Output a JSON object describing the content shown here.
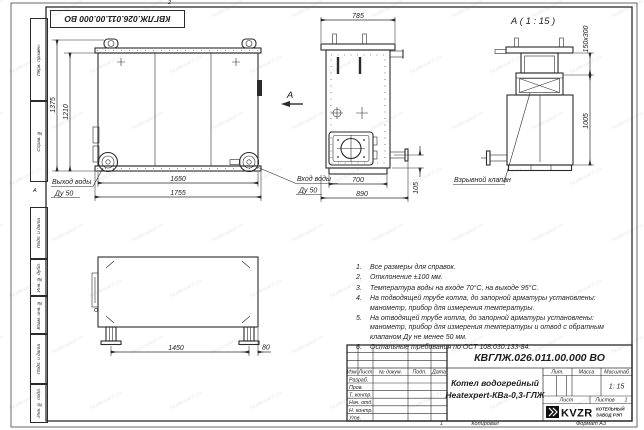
{
  "sheet": {
    "stamp_mirrored": "КВГЛЖ.026.011.00.000 ВО",
    "watermark": "heatexpert.ru",
    "zones": {
      "top": "2",
      "bottom": "1",
      "left": "А"
    },
    "margin_labels": {
      "top": [
        "Перв. примен.",
        "Справ. №"
      ],
      "bottom": [
        "Подп. и дата",
        "Инв. № дубл.",
        "Взам. инв. №",
        "Подп. и дата",
        "Инв. № подл."
      ]
    },
    "footer": {
      "copied": "Копировал",
      "format": "Формат А3"
    }
  },
  "views": {
    "front": {
      "dims": {
        "inner_width": "1650",
        "outer_width": "1755",
        "outer_height": "1375",
        "inner_height": "1210"
      },
      "outlet_label": "Выход воды",
      "outlet_dn": "Ду 50",
      "inlet_label": "Вход воды",
      "inlet_dn": "Ду 50",
      "section_arrow": "А"
    },
    "side": {
      "dims": {
        "depth": "785",
        "base_inner": "700",
        "base_outer": "890",
        "nozzle_height": "105"
      }
    },
    "detail": {
      "title": "А ( 1 : 15 )",
      "valve_label": "Взрывной клапан",
      "dims": {
        "valve_size": "150х300",
        "height": "1005"
      }
    },
    "bottom": {
      "dims": {
        "leg_span": "1450",
        "leg_offset": "80"
      }
    }
  },
  "notes": {
    "items": [
      {
        "num": "1.",
        "text": "Все размеры для справок."
      },
      {
        "num": "2.",
        "text": "Отклонение ±100 мм."
      },
      {
        "num": "3.",
        "text": "Температура воды на входе 70°С, на выходе 95°С."
      },
      {
        "num": "4.",
        "text": "На подводящей трубе котла, до запорной арматуры установлены: манометр, прибор для измерения температуры."
      },
      {
        "num": "5.",
        "text": "На отводящей трубе котла, до запорной арматуры установлены: манометр, прибор для измерения температуры и отвод с обратным клапаном Ду не менее 50 мм."
      },
      {
        "num": "6.",
        "text": "Остальные требования по ОСТ 108.030.133-84."
      }
    ]
  },
  "title_block": {
    "designation": "КВГЛЖ.026.011.00.000 ВО",
    "name_line1": "Котел водогрейный",
    "name_line2": "Heatexpert-КВа-0,3-ГЛЖ",
    "cols": {
      "izm": "Изм.",
      "list": "Лист",
      "doc": "№ докум.",
      "sign": "Подп.",
      "date": "Дата"
    },
    "rows": [
      "Разраб.",
      "Пров.",
      "Т. контр.",
      "Нач. отд.",
      "Н. контр.",
      "Утв."
    ],
    "lit": "Лит.",
    "mass": "Масса",
    "scale": "Масштаб",
    "scale_value": "1: 15",
    "sheet": "Лист",
    "sheets": "Листов",
    "sheets_value": "1",
    "logo": "KVZR",
    "org_line1": "КОТЕЛЬНЫЙ",
    "org_line2": "ЗАВОД РЭП"
  }
}
